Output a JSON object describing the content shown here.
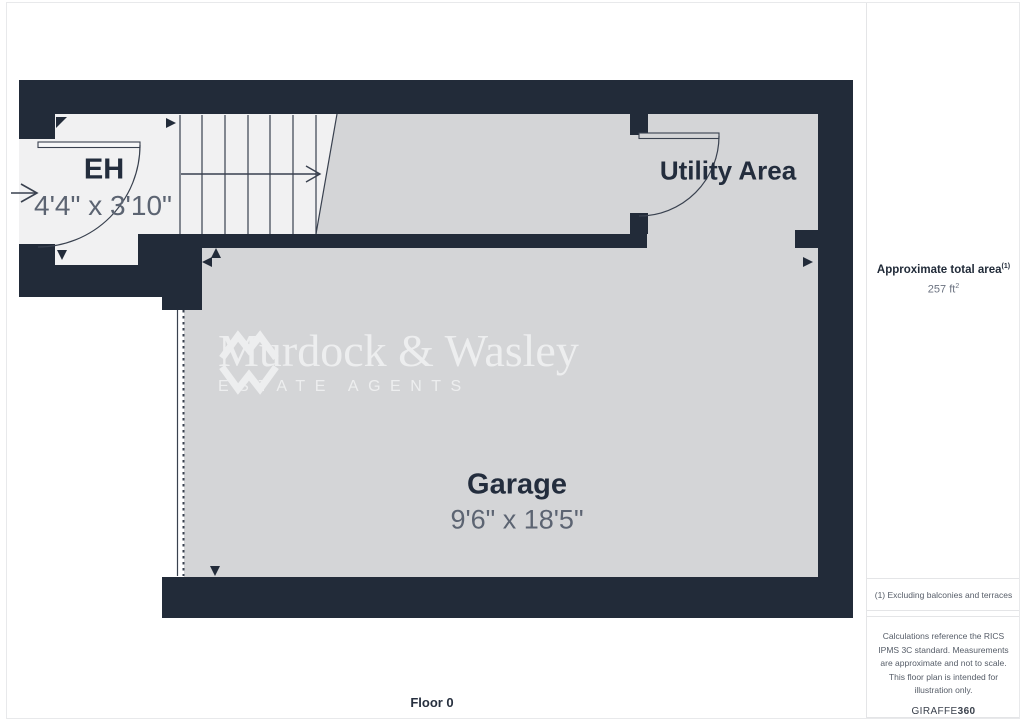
{
  "floorplan": {
    "rooms": [
      {
        "id": "eh",
        "name": "EH",
        "dims": "4'4\" x 3'10\""
      },
      {
        "id": "utility",
        "name": "Utility Area",
        "dims": ""
      },
      {
        "id": "garage",
        "name": "Garage",
        "dims": "9'6\" x 18'5\""
      }
    ],
    "floor_label": "Floor 0"
  },
  "watermark": {
    "name": "Murdock & Wasley",
    "tagline": "ESTATE AGENTS"
  },
  "sidebar": {
    "area_title": "Approximate total area",
    "area_sup": "(1)",
    "area_value": "257 ft",
    "area_value_sup": "2",
    "note1": "(1) Excluding balconies and terraces",
    "note2": "Calculations reference the RICS IPMS 3C standard. Measurements are approximate and not to scale. This floor plan is intended for illustration only.",
    "brand": "GIRAFFE",
    "brand_bold": "360"
  },
  "icons": {
    "logo": "mw-monogram-icon",
    "entry_arrow": "entry-direction-arrow-icon",
    "stair_arrow": "stair-direction-arrow-icon",
    "corner_markers": "wall-corner-marker-icon"
  },
  "colors": {
    "wall": "#222b39",
    "room_gray": "#d4d5d7",
    "room_light": "#f1f1f2",
    "label": "#232d3d",
    "dims": "#5c6472",
    "watermark": "#ffffff"
  }
}
